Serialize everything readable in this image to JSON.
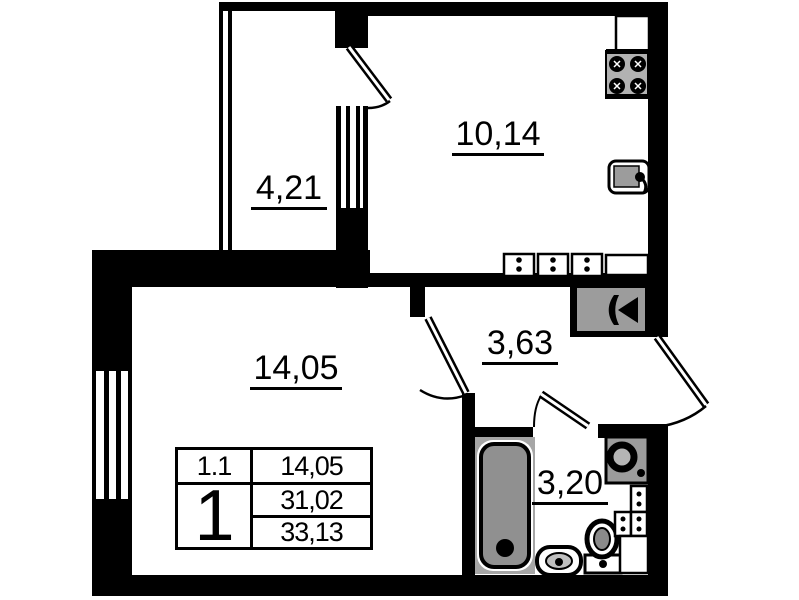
{
  "title": "apartment floor plan",
  "colors": {
    "wall": "#000000",
    "fixture_gray": "#9c9c9c",
    "text": "#000000",
    "background": "#ffffff"
  },
  "rooms": {
    "balcony": {
      "area": "4,21"
    },
    "kitchen": {
      "area": "10,14"
    },
    "living_room": {
      "area": "14,05"
    },
    "hallway": {
      "area": "3,63"
    },
    "bathroom": {
      "area": "3,20"
    }
  },
  "info_table": {
    "unit_label": "1.1",
    "unit_area": "14,05",
    "apartment_number": "1",
    "living_space": "31,02",
    "total_area": "33,13"
  },
  "fixtures": {
    "kitchen": [
      "stove-icon",
      "counter",
      "sink-icon",
      "outlet-icons"
    ],
    "hallway": [
      "ventilation-fan-icon"
    ],
    "bathroom": [
      "bathtub-icon",
      "washing-machine-icon",
      "sink-icon",
      "toilet-icon",
      "outlet-icons",
      "cabinet"
    ]
  }
}
